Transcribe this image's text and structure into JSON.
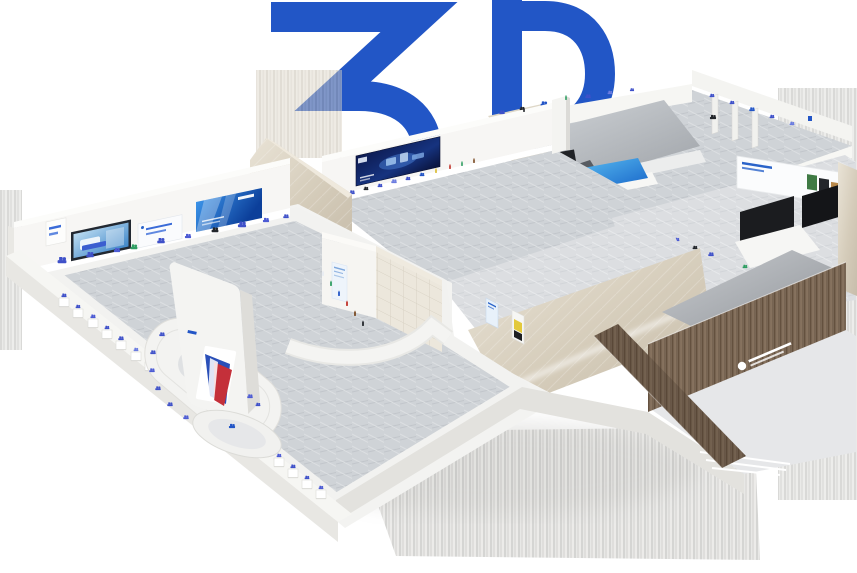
{
  "page": {
    "background": "#ffffff"
  },
  "logo": {
    "text": "3D",
    "color": "#2256c6"
  },
  "scene": {
    "label": "3D isometric exhibition hall model",
    "halls": [
      {
        "id": "main-hall",
        "label": "Main exhibition hall with center island and monolith sign"
      },
      {
        "id": "hall-2",
        "label": "Second hall with navy product banner wall"
      },
      {
        "id": "hall-3",
        "label": "Vehicle display hall with staircase and blue wedge stand"
      },
      {
        "id": "right-gallery",
        "label": "Right gallery strip with black display panels"
      },
      {
        "id": "wood-annex",
        "label": "Wooden reception annex with white signage"
      }
    ],
    "banners": [
      {
        "id": "series-label-plate",
        "label": "small product-series label plate"
      },
      {
        "id": "machine-screen",
        "label": "embedded screen showing blue pump machine"
      },
      {
        "id": "white-text-banner",
        "label": "white banner with two lines of blue text"
      },
      {
        "id": "blue-gradient-banner",
        "label": "blue gradient brand banner with logo"
      },
      {
        "id": "navy-machine-banner",
        "label": "dark navy banner with machine artwork"
      },
      {
        "id": "gallery-photo-banner",
        "label": "white banner with photo strip"
      }
    ]
  },
  "palette": {
    "accent_blue": "#2256c6",
    "floor_gray": "#cfd3d7",
    "floor_light": "#dcdee1",
    "wall_white": "#f7f6f3",
    "marble_beige": "#d8cfbe",
    "wood_brown": "#7e6b58",
    "banner_blue_start": "#3b93e8",
    "banner_blue_end": "#0c3f9a",
    "banner_navy": "#0d1a4f",
    "exhibit_blue": "#3f51c9",
    "exhibit_green": "#2f9e62",
    "exhibit_red": "#c03028",
    "panel_black": "#1b1c1f",
    "emblem_red": "#c4303a",
    "emblem_blue": "#2a4fb8",
    "shadow_gray": "#b5b4b1"
  }
}
